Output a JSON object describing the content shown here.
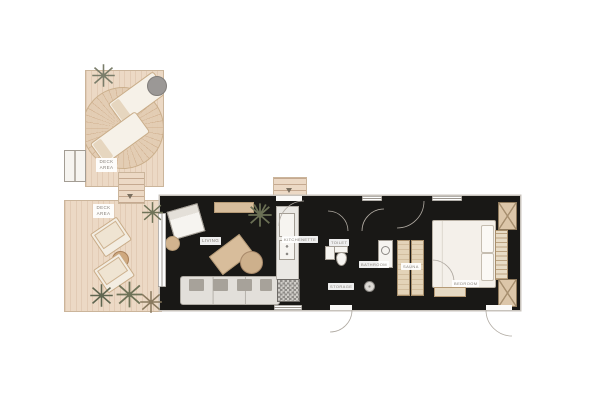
{
  "rooms": {
    "deck_upper": {
      "label": "DECK AREA"
    },
    "deck_lower": {
      "label": "DECK AREA"
    },
    "living": {
      "label": "LIVING"
    },
    "kitchenette": {
      "label": "KITCHENETTE"
    },
    "toilet": {
      "label": "TOILET"
    },
    "storage": {
      "label": "STORAGE"
    },
    "bathroom": {
      "label": "BATHROOM"
    },
    "sauna": {
      "label": "SAUNA"
    },
    "bedroom": {
      "label": "BEDROOM"
    }
  },
  "palette": {
    "background": "#ffffff",
    "wall": "#191816",
    "deck_wood": "#ecd9c5",
    "interior_floor": "#edebe7",
    "rug": "#dac3a5",
    "furniture_wood": "#d7bd9c",
    "upholstery": "#a7a29a",
    "plant_olive": "#6f7358",
    "plant_brown": "#8a7a5f",
    "label_text": "#87817a"
  },
  "furniture": {
    "deck_upper": [
      "round-fan-rug",
      "lounge-chair",
      "lounge-chair",
      "side-table",
      "plant",
      "bench",
      "stairs"
    ],
    "deck_lower": [
      "armchair",
      "armchair",
      "coffee-table",
      "plant",
      "plant",
      "plant",
      "plant"
    ],
    "living": [
      "sideboard",
      "armchair",
      "side-table",
      "area-rug",
      "desk",
      "desk-chair",
      "sofa",
      "plant"
    ],
    "kitchenette": [
      "counter",
      "sink",
      "cooktop",
      "washing-machine"
    ],
    "toilet": [
      "toilet",
      "washbasin"
    ],
    "storage": [],
    "bathroom": [
      "vanity",
      "shower-drain"
    ],
    "sauna": [
      "bench",
      "bench"
    ],
    "bedroom": [
      "double-bed",
      "pillow",
      "pillow",
      "area-rug",
      "headboard-slats",
      "wardrobe",
      "wardrobe",
      "foot-bench"
    ],
    "exterior": [
      "entry-steps"
    ]
  }
}
